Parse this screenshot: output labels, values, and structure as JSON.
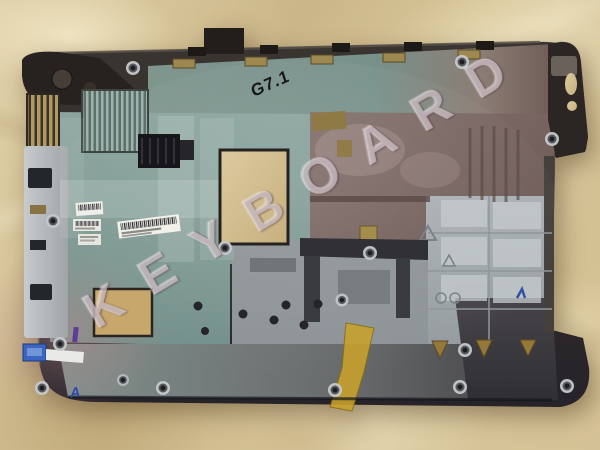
{
  "scene": {
    "description": "Used laptop bottom base enclosure photographed interior-side up on crumpled tan kraft paper",
    "handwritten_model_mark": "G7.1",
    "watermark": {
      "text": "KEYBOARD",
      "letters": [
        "K",
        "E",
        "Y",
        "B",
        "O",
        "A",
        "R",
        "D"
      ]
    },
    "inspection_marks": {
      "blue_letter": "A"
    },
    "colors": {
      "paper": "#d6c498",
      "paper_highlight": "#eadfbc",
      "paper_shadow": "#b4a077",
      "case_rim": "#2f2b29",
      "interior_teal": "#87a09a",
      "interior_mauve": "#7d6a66",
      "interior_grey": "#a4aaae",
      "vent_gold": "#b09a62",
      "kapton_tape_yellow": "#c9a22b",
      "connector_blue": "#3a66c2",
      "paint_mark_purple": "#5d3d9c",
      "watermark_tint": "#faf2f6",
      "ink_black": "#17171b",
      "ink_blue": "#2a49ae"
    }
  }
}
